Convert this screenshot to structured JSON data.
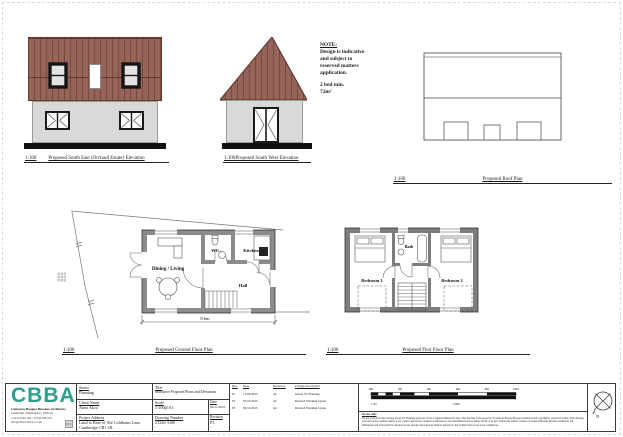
{
  "note": {
    "heading": "NOTE:",
    "l1": "Design is indicative",
    "l2": "and subject to",
    "l3": "reserved matters",
    "l4": "application.",
    "l5": "2 bed min.",
    "l6": "72m²"
  },
  "captions": {
    "se": {
      "scale": "1:100",
      "title": "Proposed South East (Orchard Estate) Elevation"
    },
    "sw": {
      "scale": "1:100",
      "title": "Proposed South West Elevation"
    },
    "roof": {
      "scale": "1:100",
      "title": "Proposed Roof Plan"
    },
    "gf": {
      "scale": "1:100",
      "title": "Proposed Ground Floor Plan"
    },
    "ff": {
      "scale": "1:100",
      "title": "Proposed First Floor Plan"
    }
  },
  "ground_floor": {
    "rooms": {
      "dining": "Dining / Living",
      "wc": "WC",
      "kitchen": "Kitchen",
      "hall": "Hall"
    },
    "dimension": "8.6m"
  },
  "first_floor": {
    "rooms": {
      "bedroom1": "Bedroom 1",
      "bath": "Bath",
      "bedroom2": "Bedroom 2"
    }
  },
  "titleblock": {
    "logo": {
      "wordmark": "CBBA",
      "firm": "Cameron Bosque Brookes Architects",
      "offices": "Cambridge | Huntingdon | Wisbech",
      "phone": "t: 01223 661 304 / 07540 638 223",
      "email": "info@cbbarchitects.co.uk",
      "color": "#2d9e8e"
    },
    "status_label": "Status",
    "status": "Planning",
    "client_label": "Client Name",
    "client": "Anna Akca",
    "address_label": "Project Address",
    "address1": "Land to Rear of 562 Coldhams Lane",
    "address2": "Cambridge CB1 3JL",
    "title_label": "Title",
    "title": "Indicative Proposed Plans and Elevations",
    "scale_label": "Scale",
    "scale": "1:100@A3",
    "date_label": "Date",
    "date": "06/11/2023",
    "dwg_label": "Drawing Number",
    "dwg": "21326-3100",
    "rev_label": "Revision",
    "rev": "P3",
    "rev_table": {
      "headers": {
        "rev": "Rev.",
        "date": "Date",
        "by": "Drawn by",
        "desc": "Change description"
      },
      "rows": [
        {
          "rev": "P1",
          "date": "11/04/2023",
          "by": "AC",
          "desc": "Issued for Planning"
        },
        {
          "rev": "P2",
          "date": "03/10/2023",
          "by": "AC",
          "desc": "Revised Planning layout"
        },
        {
          "rev": "P3",
          "date": "06/11/2023",
          "by": "AC",
          "desc": "Revised Planning layout"
        }
      ]
    },
    "scalebar": {
      "ticks": [
        "0m",
        "2m",
        "4m",
        "6m",
        "8m",
        "10m"
      ],
      "scale_left": "1:50",
      "scale_right": "1:200"
    },
    "disclaimer": {
      "heading": "Do not scale",
      "lines": [
        "Do not scale from this drawing except for Planning purposes. Work to figured dimensions only. This drawing is the property of Cameron Bosque Brookes Architects and copyright is reserved by them.",
        "This drawing is issued on the condition that it is not copied, reproduced, retained or disclosed to any unauthorised person either wholly or in part without the written consent of Cameron Bosque Brookes Architects.",
        "All dimensions and levels shall be checked on site and any discrepancies shall be reported to the architect before any work commences."
      ]
    },
    "north_label": "N"
  },
  "colors": {
    "roof": "#96655a",
    "roof_stripe": "#7a473e",
    "wall_render": "#d9d9d9",
    "logo_accent": "#2d9e8e"
  }
}
